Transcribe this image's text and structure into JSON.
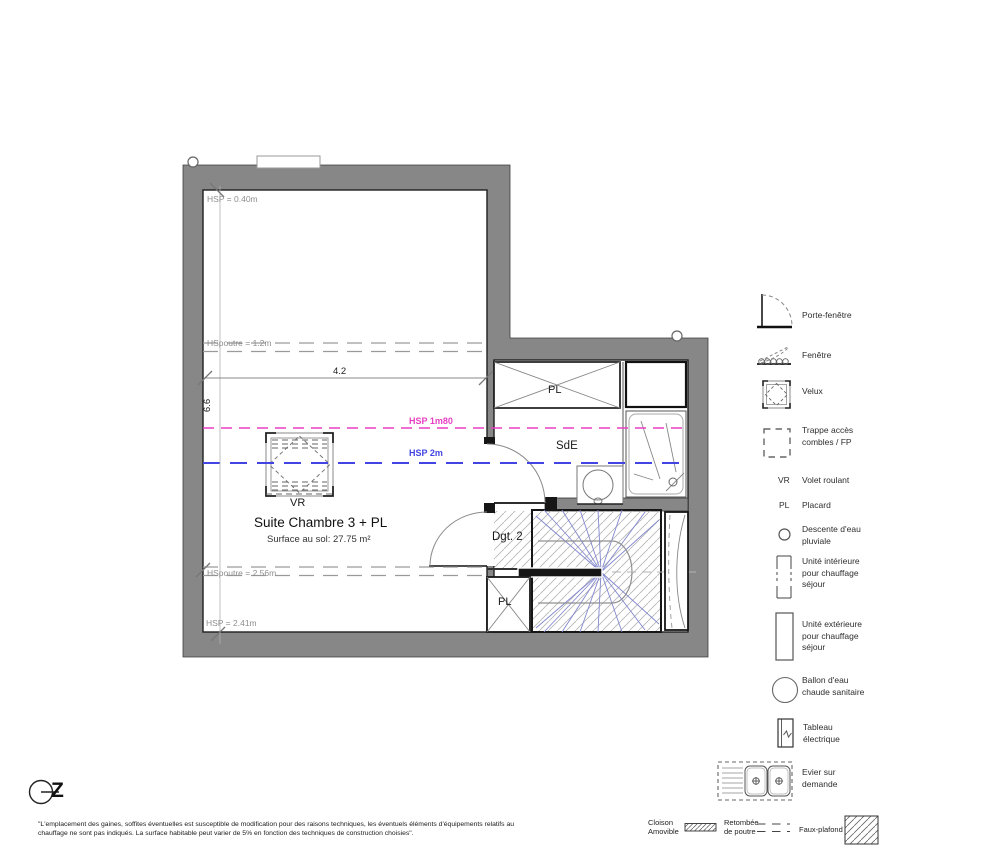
{
  "colors": {
    "wall": "#878787",
    "hsp_1m80_line": "#e93fc2",
    "hsp_2m_line": "#4245e2",
    "stair_lines": "#8287cf",
    "hatch": "#b8b8b8"
  },
  "plan": {
    "room": {
      "title": "Suite Chambre 3 + PL",
      "area": "Surface au sol: 27.75 m²"
    },
    "heights": {
      "hsp_040": "HSP = 0.40m",
      "hspoutre_12": "HSpoutre = 1.2m",
      "hsp_1m80": "HSP 1m80",
      "hsp_2m": "HSP 2m",
      "hspoutre_256": "HSpoutre = 2.56m",
      "hsp_241": "HSP = 2.41m"
    },
    "dimensions": {
      "width": "4.2",
      "height": "6.6"
    },
    "rooms": {
      "vr": "VR",
      "pl_top": "PL",
      "sde": "SdE",
      "dgt2": "Dgt. 2",
      "pl_bottom": "PL"
    },
    "north": "Z"
  },
  "legend": {
    "items": [
      {
        "label": "Porte-fenêtre"
      },
      {
        "label": "Fenêtre"
      },
      {
        "label": "Velux"
      },
      {
        "label": "Trappe accès\ncombles / FP"
      },
      {
        "abbr": "VR",
        "label": "Volet roulant"
      },
      {
        "abbr": "PL",
        "label": "Placard"
      },
      {
        "label": "Descente d'eau\npluviale"
      },
      {
        "label": "Unité intérieure\npour chauffage\nséjour"
      },
      {
        "label": "Unité extérieure\npour chauffage\nséjour"
      },
      {
        "label": "Ballon d'eau\nchaude sanitaire"
      },
      {
        "label": "Tableau\nélectrique"
      },
      {
        "label": "Evier sur\ndemande"
      }
    ],
    "bottom": {
      "cloison": "Cloison\nAmovible",
      "retombee": "Retombée\nde poutre",
      "faux_plafond": "Faux-plafond"
    }
  },
  "footer": {
    "disclaimer": "\"L'emplacement des gaines, soffites éventuelles est susceptible de modification pour des raisons techniques, les éventuels éléments d'équipements relatifs au chauffage ne sont pas indiqués. La surface habitable peut varier de 5% en fonction des techniques de construction choisies\"."
  }
}
